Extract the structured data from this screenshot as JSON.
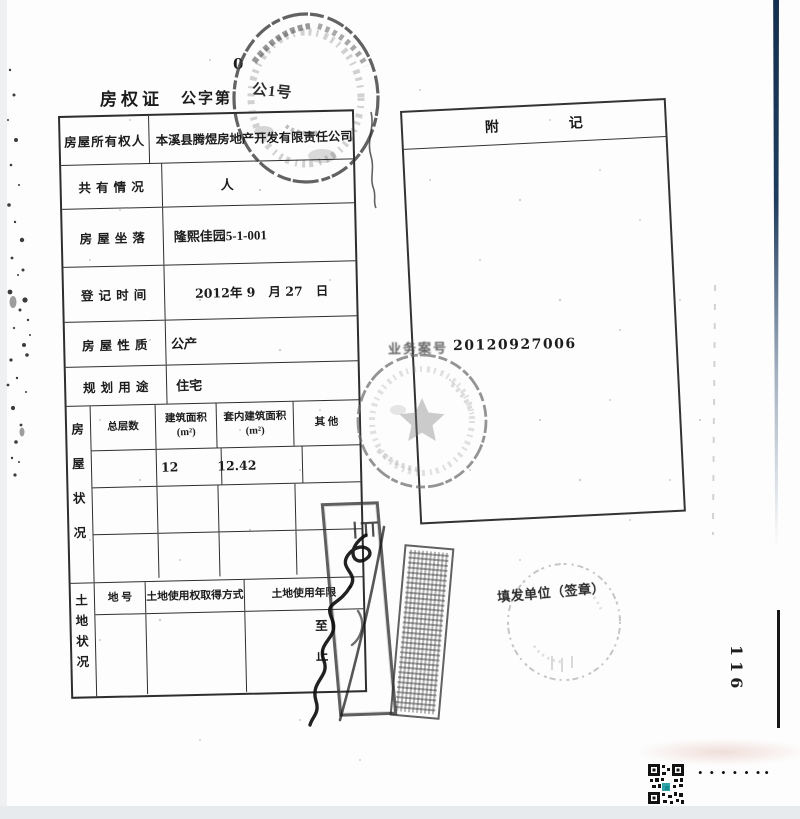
{
  "header": {
    "title": "房权证",
    "series": "公字第",
    "handwritten_zero": "0",
    "stamp_text": "公1号"
  },
  "owner_table": {
    "rows": [
      {
        "label": "房屋所有权人",
        "value": "本溪县腾煜房地产开发有限责任公司"
      },
      {
        "label": "共 有 情 况",
        "value": "人"
      },
      {
        "label": "房 屋 坐 落",
        "value": "隆熙佳园5-1-001"
      },
      {
        "label": "登 记 时 间",
        "value": "2012年 9   月 27   日"
      },
      {
        "label": "房 屋 性 质",
        "value": "公产"
      },
      {
        "label": "规 划 用 途",
        "value": "住宅"
      }
    ]
  },
  "housing": {
    "side_label": "房屋状况",
    "columns": [
      "总层数",
      "建筑面积\n(m²)",
      "套内建筑面积\n(m²)",
      "其  他"
    ],
    "values": {
      "total_floors": "",
      "floor_area": "12",
      "floor_area_overflow": "1",
      "inner_area": "2.42",
      "other": ""
    }
  },
  "land": {
    "side_label": "土地状况",
    "columns": [
      "地 号",
      "土地使用权取得方式",
      "土地使用年限"
    ],
    "term_from": "至",
    "term_to": "止"
  },
  "notes": {
    "title_left": "附",
    "title_right": "记",
    "case_label": "业务案号",
    "case_number": "20120927006"
  },
  "issuer": {
    "label": "填发单位（签章）"
  },
  "page_number": "116",
  "watermark": {
    "dots_main": "••••••",
    "dots_end": "•"
  },
  "colors": {
    "ink": "#1c1c1c",
    "seal_gray": "#6b6b6b",
    "edge_navy": "#1c3a5e",
    "qr_teal": "#1899a0"
  }
}
